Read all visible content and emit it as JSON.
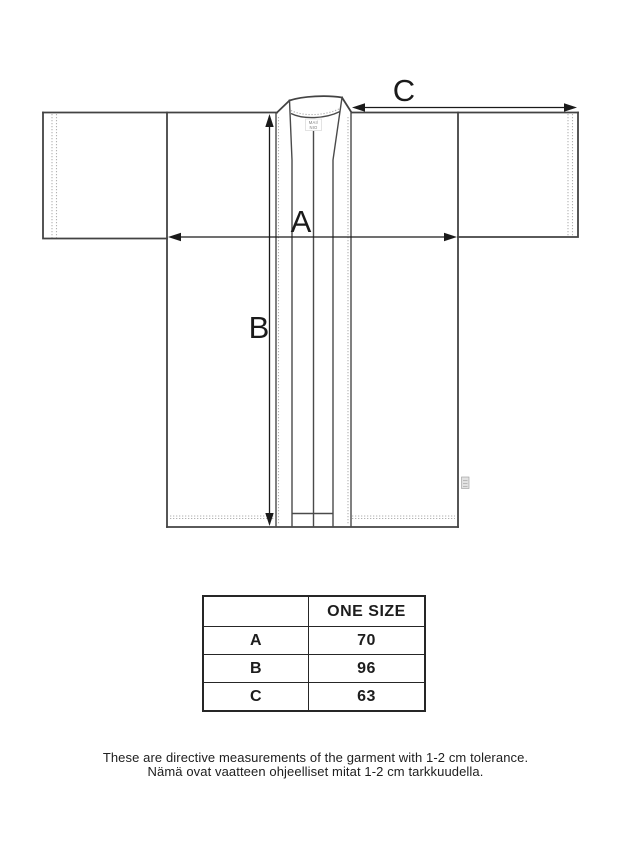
{
  "drawing": {
    "label_a": "A",
    "label_b": "B",
    "label_c": "C",
    "neck_tag_line1": "MAI/",
    "neck_tag_line2": "NIO",
    "line_color": "#434343",
    "arrow_color": "#1a1a1a",
    "stitch_color": "#b2b2b2"
  },
  "size_table": {
    "header": {
      "col1": "",
      "col2": "ONE SIZE"
    },
    "rows": [
      {
        "label": "A",
        "value": "70"
      },
      {
        "label": "B",
        "value": "96"
      },
      {
        "label": "C",
        "value": "63"
      }
    ]
  },
  "caption": {
    "line1": "These are directive measurements of the garment with 1-2 cm tolerance.",
    "line2": "Nämä ovat vaatteen ohjeelliset mitat 1-2 cm tarkkuudella."
  }
}
